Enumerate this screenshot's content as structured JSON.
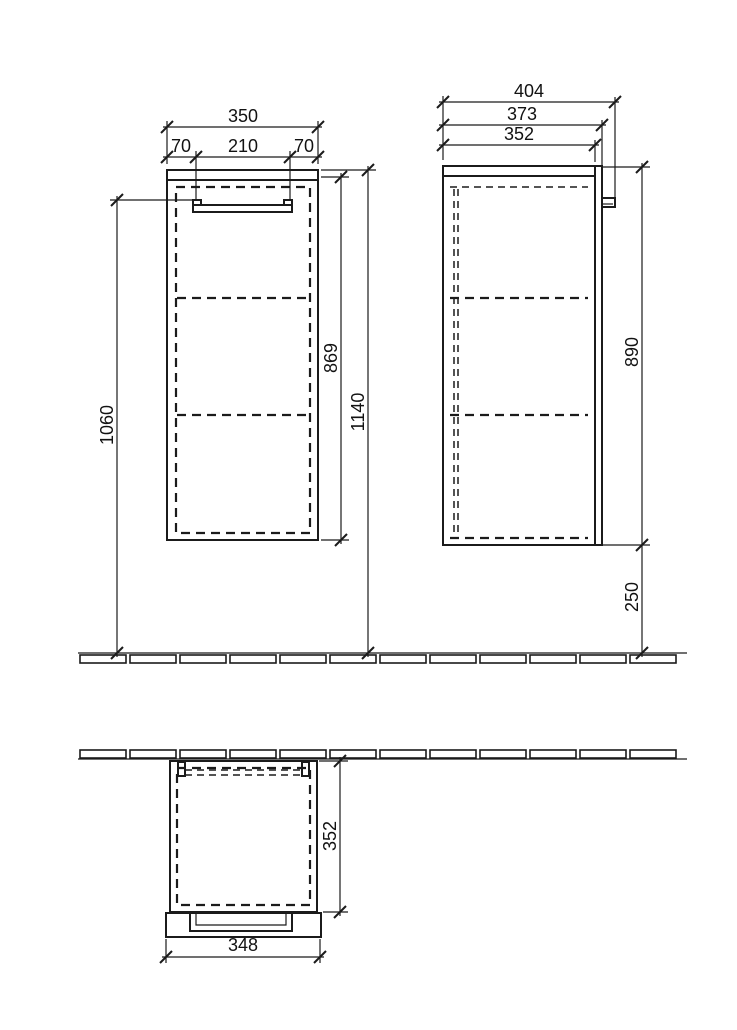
{
  "page": {
    "background_color": "#ffffff",
    "line_color": "#1b1b1b",
    "description": "Technical dimension drawing of a wall-mounted bathroom side cabinet: front elevation, side elevation and top plan view with floor and wall section hatching"
  },
  "views": {
    "front": "front elevation",
    "side": "side elevation",
    "plan": "top plan view"
  },
  "dimensions_mm": {
    "front": {
      "total_width": "350",
      "handle_offset_left": "70",
      "handle_width": "210",
      "handle_offset_right": "70",
      "handle_height_from_floor": "1060",
      "carcass_height": "869",
      "total_height_from_floor": "1140"
    },
    "side": {
      "total_depth": "404",
      "depth_incl_door": "373",
      "carcass_depth": "352",
      "cabinet_height": "890",
      "clearance_below": "250"
    },
    "plan": {
      "depth": "352",
      "door_width": "348"
    }
  }
}
